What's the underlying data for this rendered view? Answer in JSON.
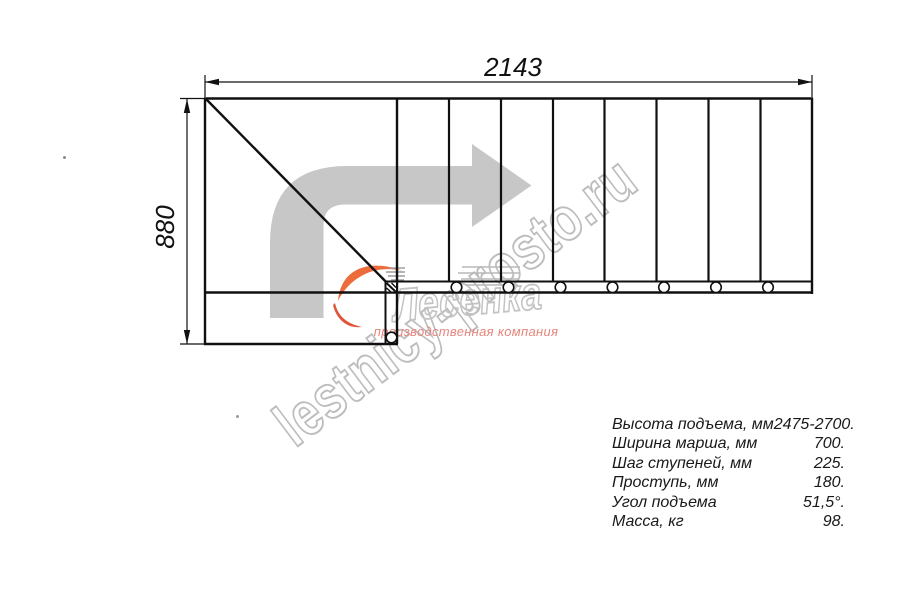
{
  "drawing": {
    "dimensions": {
      "width_label": "2143",
      "height_label": "880"
    },
    "step_count": 8,
    "connector_circle_count": 7,
    "icons": {
      "direction_arrow": "turn-right-arrow",
      "logo_swoosh": "orange-swoosh"
    }
  },
  "specs": {
    "rows": [
      {
        "label": "Высота подъема, мм",
        "value": "2475-2700."
      },
      {
        "label": "Ширина марша, мм",
        "value": "700."
      },
      {
        "label": "Шаг ступеней, мм",
        "value": "225."
      },
      {
        "label": "Проступь, мм",
        "value": "180."
      },
      {
        "label": "Угол подъема",
        "value": "51,5°."
      },
      {
        "label": "Масса, кг",
        "value": "98."
      }
    ]
  },
  "watermark": {
    "site_text": "lestnicy-prosto.ru",
    "company_name": "Лесенка",
    "tagline": "производственная компания"
  },
  "colors": {
    "line": "#101010",
    "arrow_gray": "#c7c7c7",
    "watermark_gray": "#bdbdbd",
    "logo_orange": "#ec6c3c",
    "tagline_salmon": "#e5857c"
  }
}
